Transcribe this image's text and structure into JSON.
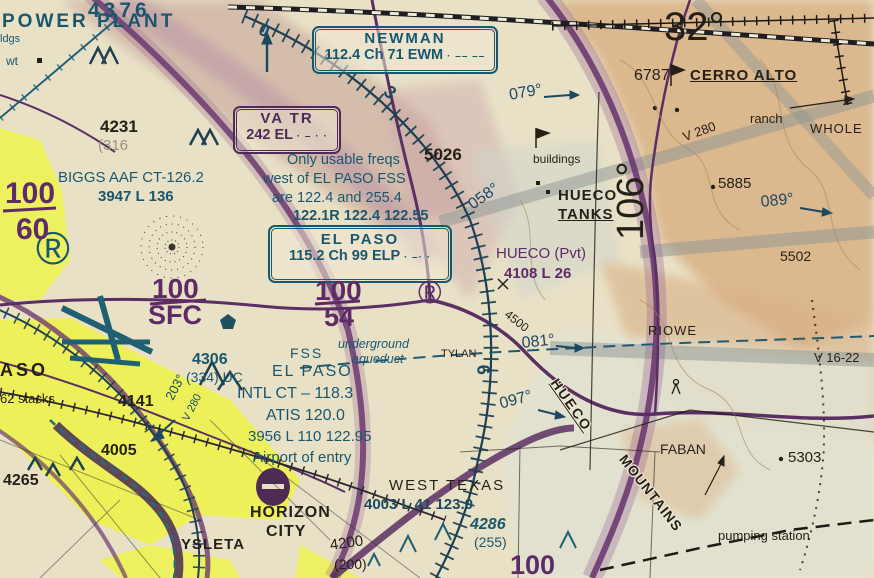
{
  "chart": {
    "title": "El Paso VFR sectional chart excerpt",
    "latitude_label": "32°",
    "longitude_label": "106°",
    "colors": {
      "aero_blue": "#19576e",
      "aero_purple": "#5e2b66",
      "terrain_tan": "#d9b185",
      "city_yellow": "#edf24c"
    }
  },
  "navaid_boxes": [
    {
      "name": "NEWMAN",
      "freq": "112.4 Ch 71 EWM",
      "morse": "· –– ––"
    },
    {
      "name": "EL PASO",
      "freq": "115.2 Ch 99 ELP",
      "morse": "· –· ·"
    },
    {
      "name": "VA TR",
      "freq": "242 EL",
      "morse": "· – · ·"
    }
  ],
  "notes": {
    "fss_note": [
      "Only usable freqs",
      "west of EL PASO FSS",
      "are 122.4 and 255.4",
      "122.1R 122.4 122.55"
    ]
  },
  "labels": [
    {
      "n": "power-plant-label",
      "t": "POWER PLANT",
      "x": 2,
      "y": 12,
      "s": 19,
      "c": "teal b",
      "sp": 3
    },
    {
      "n": "bldgs-fragment",
      "t": "ldgs",
      "x": 0,
      "y": 34,
      "s": 11,
      "c": "teal"
    },
    {
      "n": "elev-4376",
      "t": "4376",
      "x": 88,
      "y": 0,
      "s": 21,
      "c": "teal b",
      "sp": 4
    },
    {
      "n": "wt-label",
      "t": "wt",
      "x": 6,
      "y": 55,
      "s": 12,
      "c": "teal"
    },
    {
      "n": "registered-symbol-1",
      "t": "®",
      "x": 36,
      "y": 224,
      "s": 46,
      "c": "teal"
    },
    {
      "n": "obst-4231",
      "t": "4231",
      "x": 100,
      "y": 118,
      "s": 17,
      "c": "black b"
    },
    {
      "n": "obst-4231-agl",
      "t": "(316",
      "x": 98,
      "y": 138,
      "s": 15,
      "c": "gray"
    },
    {
      "n": "biggs-aaf-label",
      "t": "BIGGS AAF CT-126.2",
      "x": 58,
      "y": 170,
      "s": 15,
      "c": "teal"
    },
    {
      "n": "biggs-aaf-data",
      "t": "3947 L 136",
      "x": 98,
      "y": 189,
      "s": 15,
      "c": "teal b"
    },
    {
      "n": "alt-100-60-top",
      "t": "100",
      "x": 5,
      "y": 178,
      "s": 30,
      "c": "purple b"
    },
    {
      "n": "alt-100-60-bottom",
      "t": "60",
      "x": 16,
      "y": 214,
      "s": 30,
      "c": "purple b"
    },
    {
      "n": "note-line-1",
      "t": "Only usable freqs",
      "x": 287,
      "y": 153,
      "s": 14.5,
      "c": "teal"
    },
    {
      "n": "note-line-2",
      "t": "west of EL PASO FSS",
      "x": 263,
      "y": 172,
      "s": 14.5,
      "c": "teal"
    },
    {
      "n": "note-line-3",
      "t": "are 122.4 and 255.4",
      "x": 272,
      "y": 191,
      "s": 14.5,
      "c": "teal"
    },
    {
      "n": "note-line-4",
      "t": "122.1R 122.4 122.55",
      "x": 293,
      "y": 209,
      "s": 14.5,
      "c": "teal b"
    },
    {
      "n": "elev-5026",
      "t": "5026",
      "x": 424,
      "y": 146,
      "s": 17,
      "c": "black b"
    },
    {
      "n": "crs-079",
      "t": "079°",
      "x": 508,
      "y": 88,
      "s": 16,
      "c": "navy",
      "r": -10
    },
    {
      "n": "buildings-label",
      "t": "buildings",
      "x": 533,
      "y": 153,
      "s": 12,
      "c": "black"
    },
    {
      "n": "hueco-tanks-line1",
      "t": "HUECO",
      "x": 558,
      "y": 188,
      "s": 15,
      "c": "black b",
      "sp": 1
    },
    {
      "n": "hueco-tanks-line2",
      "t": "TANKS",
      "x": 558,
      "y": 207,
      "s": 15,
      "c": "black b",
      "sp": 1,
      "u": 1
    },
    {
      "n": "crs-058",
      "t": "058°",
      "x": 466,
      "y": 200,
      "s": 16,
      "c": "navy",
      "r": -35
    },
    {
      "n": "hueco-pvt-label",
      "t": "HUECO (Pvt)",
      "x": 496,
      "y": 246,
      "s": 15,
      "c": "purple"
    },
    {
      "n": "hueco-pvt-data",
      "t": "4108 L 26",
      "x": 504,
      "y": 266,
      "s": 15,
      "c": "purple b"
    },
    {
      "n": "lat-32-label",
      "t": "32°",
      "x": 664,
      "y": 6,
      "s": 40,
      "c": "black"
    },
    {
      "n": "elev-6787",
      "t": "6787",
      "x": 634,
      "y": 68,
      "s": 16,
      "c": "black"
    },
    {
      "n": "cerro-alto-label",
      "t": "CERRO ALTO",
      "x": 690,
      "y": 68,
      "s": 15,
      "c": "black b",
      "sp": 1,
      "u": 1
    },
    {
      "n": "ranch-label",
      "t": "ranch",
      "x": 750,
      "y": 112,
      "s": 13,
      "c": "black"
    },
    {
      "n": "whole-label",
      "t": "WHOLE",
      "x": 810,
      "y": 122,
      "s": 13,
      "c": "black",
      "sp": 1
    },
    {
      "n": "awy-v280-label",
      "t": "V 280",
      "x": 681,
      "y": 131,
      "s": 13,
      "c": "black",
      "r": -20
    },
    {
      "n": "elev-5885",
      "t": "5885",
      "x": 718,
      "y": 176,
      "s": 15,
      "c": "black"
    },
    {
      "n": "crs-089",
      "t": "089°",
      "x": 760,
      "y": 195,
      "s": 16,
      "c": "navy",
      "r": -6
    },
    {
      "n": "lon-106-label",
      "t": "106°",
      "x": 612,
      "y": 240,
      "s": 38,
      "c": "black",
      "r": -90
    },
    {
      "n": "elev-5502",
      "t": "5502",
      "x": 780,
      "y": 249,
      "s": 14,
      "c": "black"
    },
    {
      "n": "riowe-label",
      "t": "RIOWE",
      "x": 648,
      "y": 324,
      "s": 13,
      "c": "black",
      "sp": 1
    },
    {
      "n": "awy-v16-22-label",
      "t": "V 16-22",
      "x": 814,
      "y": 351,
      "s": 13,
      "c": "black"
    },
    {
      "n": "crs-081",
      "t": "081°",
      "x": 521,
      "y": 336,
      "s": 16,
      "c": "navy",
      "r": -6
    },
    {
      "n": "hueco-mtns-word1",
      "t": "HUECO",
      "x": 560,
      "y": 376,
      "s": 14,
      "c": "black b halo",
      "r": 55,
      "sp": 2,
      "u": 1
    },
    {
      "n": "hueco-mtns-word2",
      "t": "MOUNTAINS",
      "x": 628,
      "y": 452,
      "s": 14,
      "c": "black b halo",
      "r": 52,
      "sp": 1
    },
    {
      "n": "faban-label",
      "t": "FABAN",
      "x": 660,
      "y": 442,
      "s": 14,
      "c": "black"
    },
    {
      "n": "elev-5303",
      "t": "5303",
      "x": 788,
      "y": 450,
      "s": 15,
      "c": "black"
    },
    {
      "n": "pumping-station-label",
      "t": "pumping   station",
      "x": 718,
      "y": 529,
      "s": 13,
      "c": "black"
    },
    {
      "n": "tylan-label",
      "t": "TYLAN",
      "x": 441,
      "y": 349,
      "s": 11,
      "c": "black"
    },
    {
      "n": "aqueduct-label-1",
      "t": "underground",
      "x": 338,
      "y": 338,
      "s": 12.5,
      "c": "teal i"
    },
    {
      "n": "aqueduct-label-2",
      "t": "aqueduct",
      "x": 352,
      "y": 353,
      "s": 12.5,
      "c": "teal i"
    },
    {
      "n": "contour-4500",
      "t": "4500",
      "x": 510,
      "y": 308,
      "s": 12,
      "c": "black",
      "r": 38
    },
    {
      "n": "fss-label",
      "t": "FSS",
      "x": 290,
      "y": 346,
      "s": 14,
      "c": "teal",
      "sp": 2
    },
    {
      "n": "el-paso-fss-label",
      "t": "EL PASO",
      "x": 272,
      "y": 364,
      "s": 16,
      "c": "teal",
      "sp": 2
    },
    {
      "n": "intl-ct-label",
      "t": "INTL CT – 118.3",
      "x": 237,
      "y": 386,
      "s": 16,
      "c": "teal"
    },
    {
      "n": "atis-label",
      "t": "ATIS 120.0",
      "x": 266,
      "y": 408,
      "s": 16,
      "c": "teal"
    },
    {
      "n": "elp-data-label",
      "t": "3956 L 110 122.95",
      "x": 248,
      "y": 429,
      "s": 15,
      "c": "teal"
    },
    {
      "n": "airport-of-entry-label",
      "t": "Airport of entry",
      "x": 253,
      "y": 450,
      "s": 15,
      "c": "teal"
    },
    {
      "n": "obst-4306",
      "t": "4306",
      "x": 192,
      "y": 352,
      "s": 16,
      "c": "teal b"
    },
    {
      "n": "obst-4306-agl",
      "t": "(334) UC",
      "x": 186,
      "y": 370,
      "s": 14,
      "c": "teal"
    },
    {
      "n": "stacks-label",
      "t": "62 stacks",
      "x": 0,
      "y": 392,
      "s": 13,
      "c": "black"
    },
    {
      "n": "elev-4141",
      "t": "4141",
      "x": 118,
      "y": 394,
      "s": 16,
      "c": "black b"
    },
    {
      "n": "elev-4005",
      "t": "4005",
      "x": 101,
      "y": 443,
      "s": 16,
      "c": "black b"
    },
    {
      "n": "elev-4265",
      "t": "4265",
      "x": 3,
      "y": 473,
      "s": 16,
      "c": "black b"
    },
    {
      "n": "crs-203",
      "t": "203°",
      "x": 163,
      "y": 396,
      "s": 13,
      "c": "navy",
      "r": -62
    },
    {
      "n": "awy-v280-left-label",
      "t": "V 280",
      "x": 181,
      "y": 418,
      "s": 11,
      "c": "navy",
      "r": -62
    },
    {
      "n": "el-paso-city-fragment",
      "t": "ASO",
      "x": 0,
      "y": 361,
      "s": 18,
      "c": "black b",
      "sp": 3
    },
    {
      "n": "horizon-city-line1",
      "t": "HORIZON",
      "x": 250,
      "y": 505,
      "s": 16,
      "c": "black b",
      "sp": 1
    },
    {
      "n": "horizon-city-line2",
      "t": "CITY",
      "x": 266,
      "y": 524,
      "s": 16,
      "c": "black b",
      "sp": 1
    },
    {
      "n": "ysleta-label",
      "t": "YSLETA",
      "x": 181,
      "y": 537,
      "s": 15,
      "c": "black b",
      "sp": 1
    },
    {
      "n": "west-texas-label",
      "t": "WEST TEXAS",
      "x": 389,
      "y": 478,
      "s": 15,
      "c": "black",
      "sp": 2
    },
    {
      "n": "west-texas-data",
      "t": "4003 L 41 123.0",
      "x": 364,
      "y": 497,
      "s": 15,
      "c": "navy b"
    },
    {
      "n": "obst-4286",
      "t": "4286",
      "x": 470,
      "y": 517,
      "s": 16,
      "c": "teal b i"
    },
    {
      "n": "obst-4286-agl",
      "t": "(255)",
      "x": 474,
      "y": 535,
      "s": 14,
      "c": "teal"
    },
    {
      "n": "alt-100-bottom",
      "t": "100",
      "x": 510,
      "y": 551,
      "s": 27,
      "c": "purple b"
    },
    {
      "n": "obst-4200",
      "t": "4200",
      "x": 329,
      "y": 538,
      "s": 15,
      "c": "black",
      "r": -8
    },
    {
      "n": "obst-4200-agl",
      "t": "(200)",
      "x": 334,
      "y": 557,
      "s": 14,
      "c": "black"
    },
    {
      "n": "crs-097",
      "t": "097°",
      "x": 498,
      "y": 397,
      "s": 16,
      "c": "navy",
      "r": -15
    },
    {
      "n": "alt-100-sfc-top",
      "t": "100",
      "x": 152,
      "y": 274,
      "s": 28,
      "c": "purple b"
    },
    {
      "n": "alt-100-sfc-bottom",
      "t": "SFC",
      "x": 148,
      "y": 301,
      "s": 27,
      "c": "purple b"
    },
    {
      "n": "alt-100-54-top",
      "t": "100",
      "x": 315,
      "y": 276,
      "s": 28,
      "c": "purple b"
    },
    {
      "n": "alt-100-54-bottom",
      "t": "54",
      "x": 324,
      "y": 303,
      "s": 27,
      "c": "purple b"
    },
    {
      "n": "registered-symbol-2",
      "t": "®",
      "x": 418,
      "y": 276,
      "s": 32,
      "c": "purple"
    },
    {
      "n": "rose-digit-0",
      "t": "0",
      "x": 263,
      "y": 20,
      "s": 18,
      "c": "navy b",
      "r": 22
    },
    {
      "n": "rose-digit-3",
      "t": "3",
      "x": 392,
      "y": 82,
      "s": 18,
      "c": "navy b",
      "r": 40
    },
    {
      "n": "rose-digit-6",
      "t": "6",
      "x": 492,
      "y": 364,
      "s": 18,
      "c": "navy b",
      "r": 85
    }
  ]
}
